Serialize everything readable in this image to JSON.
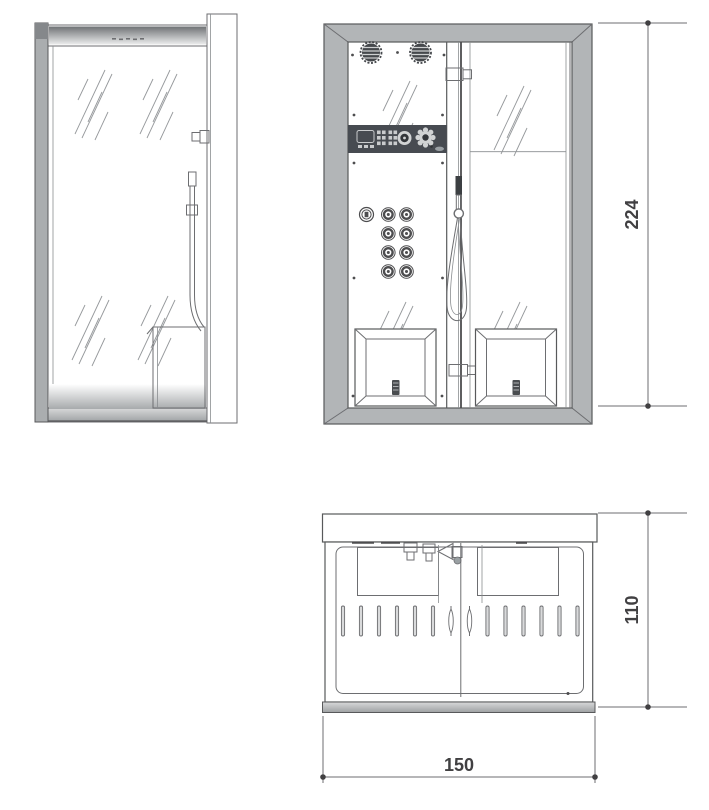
{
  "drawing": {
    "dimensions": {
      "height": "224",
      "depth": "110",
      "width": "150"
    },
    "colors": {
      "frame_fill": "#b2b5b7",
      "outline": "#58595b",
      "line": "#6d6e71",
      "control_panel": "#474b51",
      "fixture_dark": "#45484c",
      "dim_text": "#414042"
    }
  }
}
